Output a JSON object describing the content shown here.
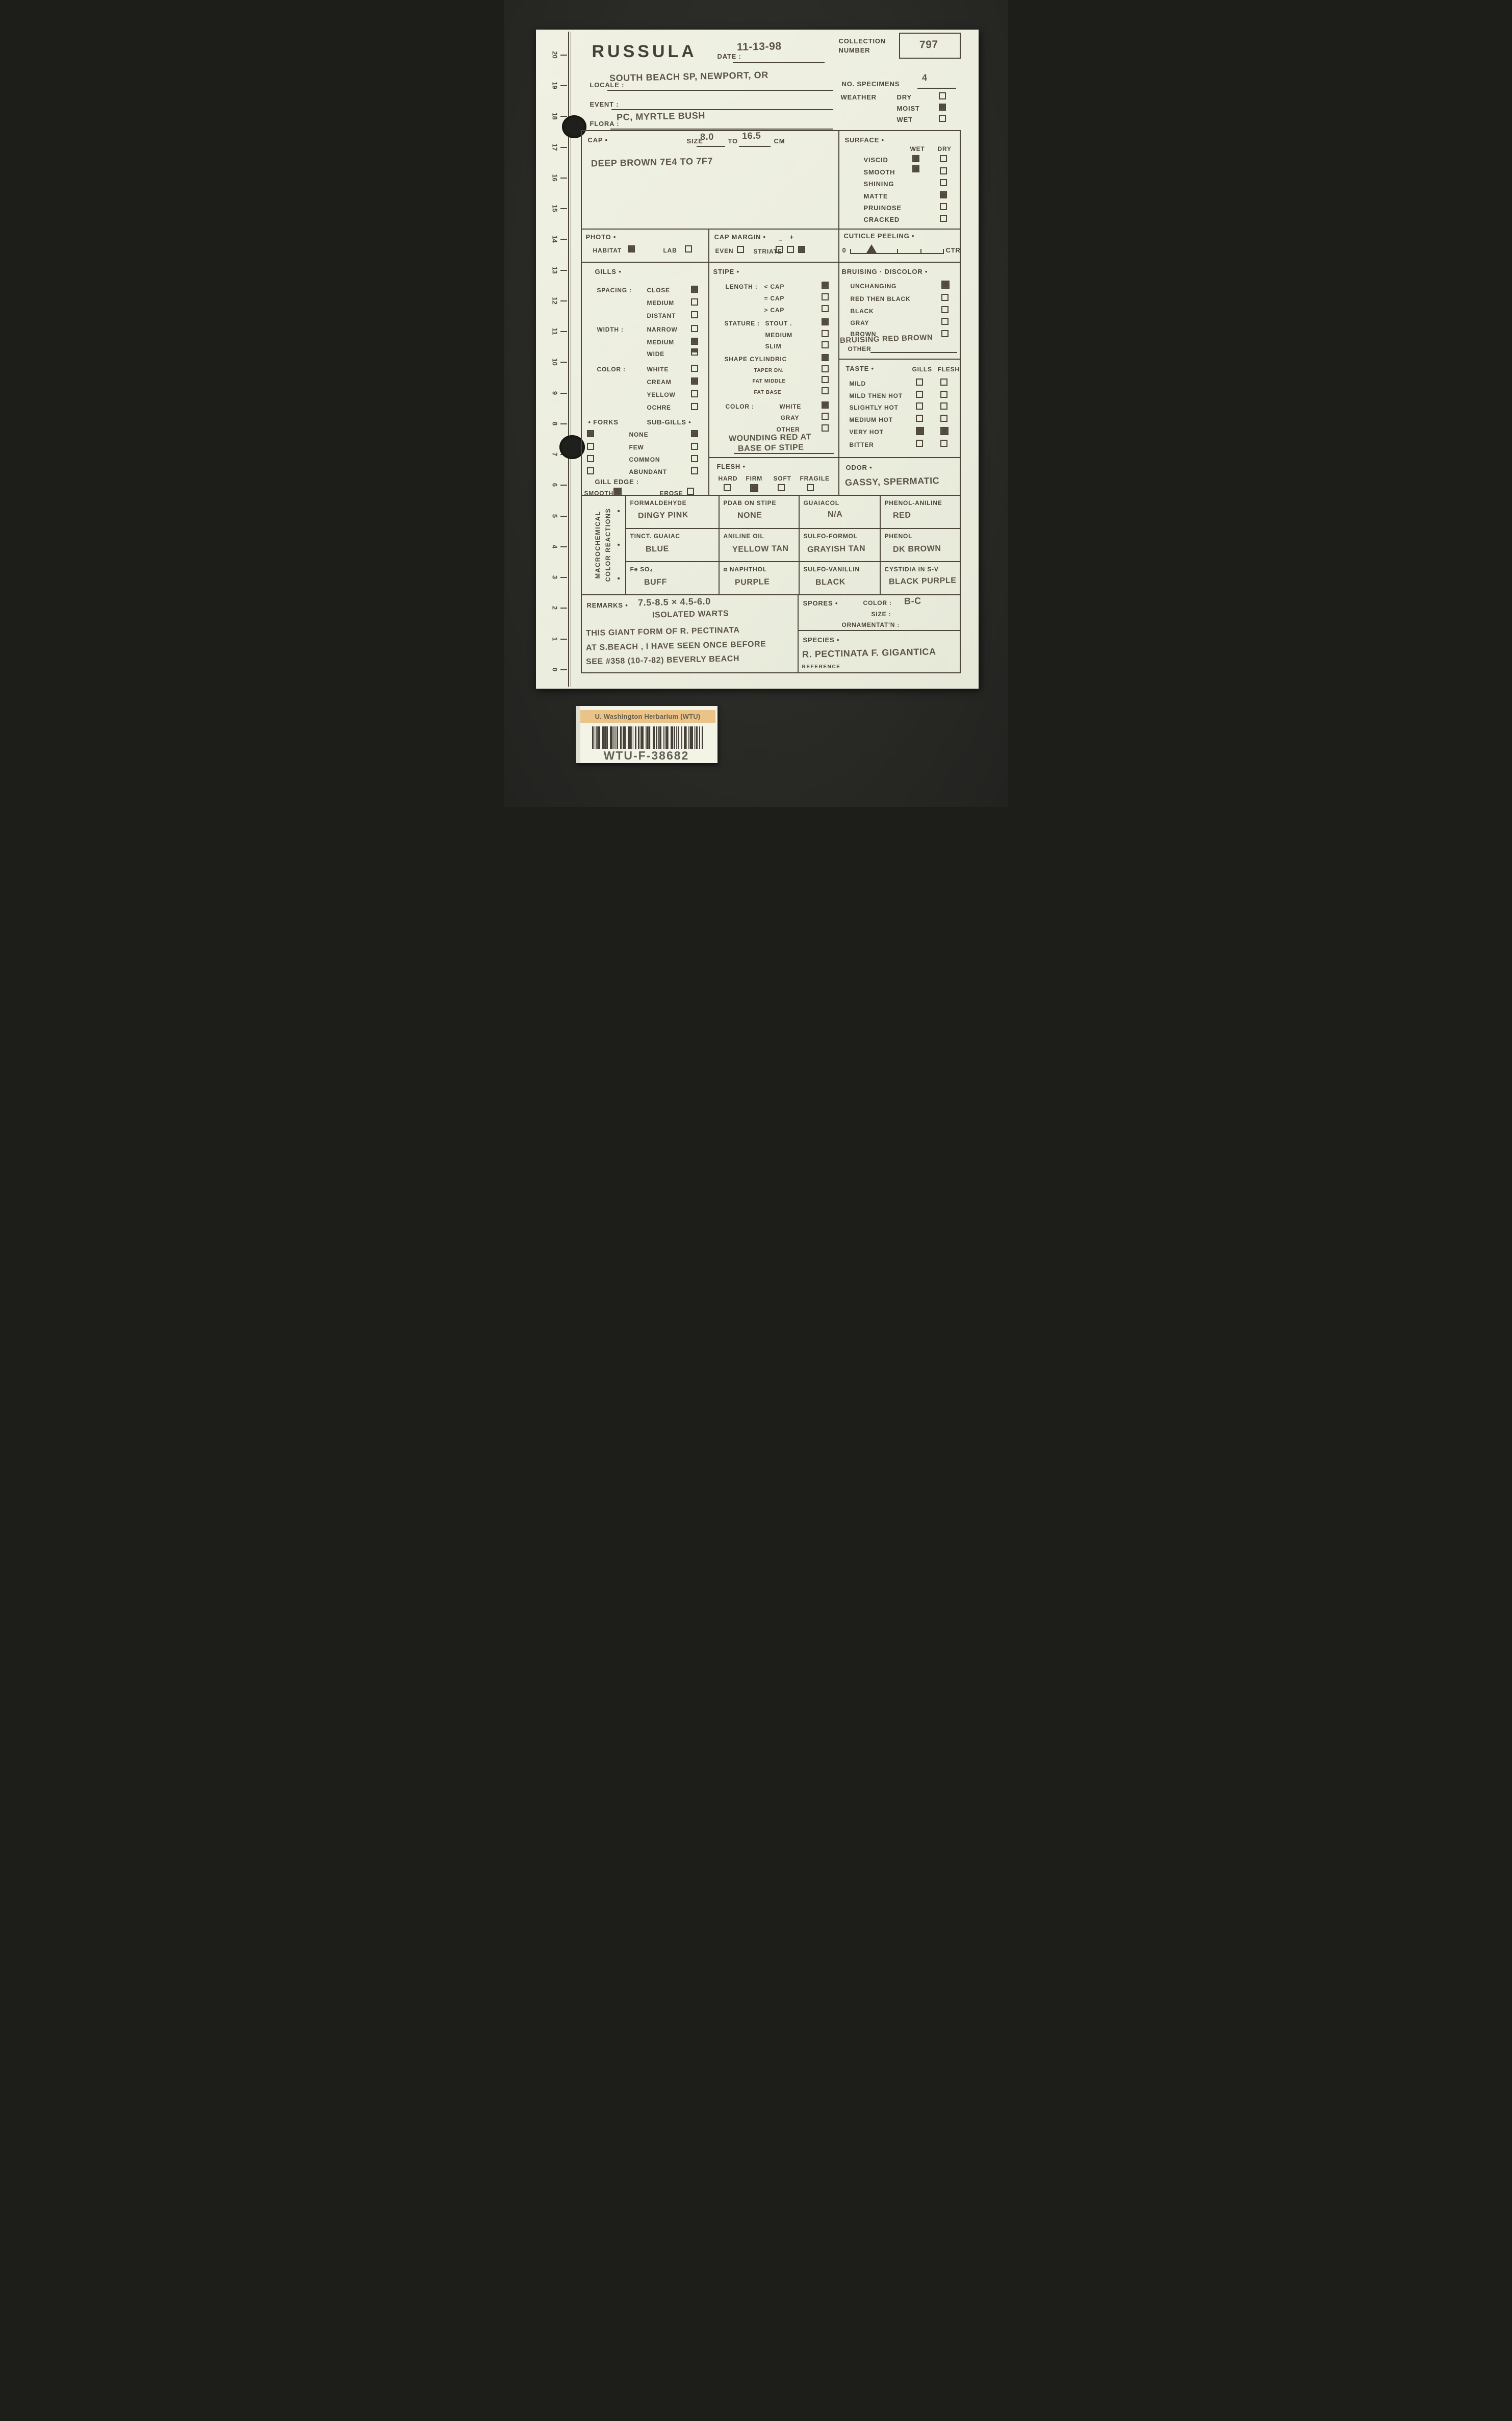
{
  "ruler": {
    "numbers": [
      "20",
      "19",
      "18",
      "17",
      "16",
      "15",
      "14",
      "13",
      "12",
      "11",
      "10",
      "9",
      "8",
      "7",
      "6",
      "5",
      "4",
      "3",
      "2",
      "1",
      "0"
    ]
  },
  "header": {
    "title": "RUSSULA",
    "date_label": "DATE :",
    "date_value": "11-13-98",
    "collection_label_1": "COLLECTION",
    "collection_label_2": "NUMBER",
    "collection_value": "797",
    "locale_label": "LOCALE :",
    "locale_value": "SOUTH BEACH SP, NEWPORT, OR",
    "no_specimens_label": "NO. SPECIMENS",
    "no_specimens_value": "4",
    "weather_label": "WEATHER",
    "weather": [
      {
        "label": "DRY",
        "checked": false
      },
      {
        "label": "MOIST",
        "checked": true
      },
      {
        "label": "WET",
        "checked": false
      }
    ],
    "event_label": "EVENT :",
    "event_value": "",
    "flora_label": "FLORA :",
    "flora_value": "PC, MYRTLE BUSH"
  },
  "cap": {
    "label": "CAP •",
    "size_label": "SIZE",
    "size_min": "8.0",
    "to_label": "TO",
    "size_max": "16.5",
    "unit_label": "CM",
    "color_note": "DEEP BROWN 7E4 TO 7F7"
  },
  "surface": {
    "label": "SURFACE •",
    "wet_header": "WET",
    "dry_header": "DRY",
    "rows": [
      {
        "label": "VISCID",
        "wet": true,
        "dry": false
      },
      {
        "label": "SMOOTH",
        "wet": true,
        "dry": false
      },
      {
        "label": "SHINING",
        "dry": false
      },
      {
        "label": "MATTE",
        "dry": true
      },
      {
        "label": "PRUINOSE",
        "dry": false
      },
      {
        "label": "CRACKED",
        "dry": false
      }
    ]
  },
  "photo": {
    "label": "PHOTO •",
    "habitat_label": "HABITAT",
    "habitat_checked": true,
    "lab_label": "LAB",
    "lab_checked": false
  },
  "cap_margin": {
    "label": "CAP MARGIN •",
    "even_label": "EVEN",
    "even_checked": false,
    "striate_label": "STRIATE",
    "minus": "−",
    "plus": "+",
    "boxes": [
      false,
      false,
      true
    ]
  },
  "cuticle": {
    "label": "CUTICLE PEELING •",
    "zero_label": "0",
    "ctr_label": "CTR"
  },
  "gills": {
    "label": "GILLS •",
    "spacing_label": "SPACING :",
    "spacing": [
      {
        "label": "CLOSE",
        "checked": true
      },
      {
        "label": "MEDIUM",
        "checked": false
      },
      {
        "label": "DISTANT",
        "checked": false
      }
    ],
    "width_label": "WIDTH :",
    "width": [
      {
        "label": "NARROW",
        "checked": false
      },
      {
        "label": "MEDIUM",
        "checked": true
      },
      {
        "label": "WIDE",
        "checked": "half"
      }
    ],
    "color_label": "COLOR :",
    "color": [
      {
        "label": "WHITE",
        "checked": false
      },
      {
        "label": "CREAM",
        "checked": true
      },
      {
        "label": "YELLOW",
        "checked": false
      },
      {
        "label": "OCHRE",
        "checked": false
      }
    ],
    "forks_label": "• FORKS",
    "subgills_label": "SUB-GILLS •",
    "amount_rows": [
      {
        "label": "NONE",
        "forks": true,
        "sub": true
      },
      {
        "label": "FEW",
        "forks": false,
        "sub": false
      },
      {
        "label": "COMMON",
        "forks": false,
        "sub": false
      },
      {
        "label": "ABUNDANT",
        "forks": false,
        "sub": false
      }
    ],
    "edge_label": "GILL EDGE :",
    "smooth_label": "SMOOTH",
    "smooth_checked": true,
    "erose_label": "EROSE",
    "erose_checked": false
  },
  "stipe": {
    "label": "STIPE •",
    "length_label": "LENGTH :",
    "length": [
      {
        "label": "< CAP",
        "checked": true
      },
      {
        "label": "= CAP",
        "checked": false
      },
      {
        "label": "> CAP",
        "checked": false
      }
    ],
    "stature_label": "STATURE :",
    "stature": [
      {
        "label": "STOUT .",
        "checked": true
      },
      {
        "label": "MEDIUM",
        "checked": false
      },
      {
        "label": "SLIM",
        "checked": false
      }
    ],
    "shape_label": "SHAPE :",
    "shape": [
      {
        "label": "CYLINDRIC",
        "checked": true
      },
      {
        "label": "TAPER DN.",
        "checked": false
      },
      {
        "label": "FAT MIDDLE",
        "checked": false
      },
      {
        "label": "FAT BASE",
        "checked": false
      }
    ],
    "color_label": "COLOR :",
    "color": [
      {
        "label": "WHITE",
        "checked": true
      },
      {
        "label": "GRAY",
        "checked": false
      },
      {
        "label": "OTHER",
        "checked": false
      }
    ],
    "note_1": "WOUNDING RED AT",
    "note_2": "BASE OF STIPE"
  },
  "bruising": {
    "label": "BRUISING · DISCOLOR •",
    "options": [
      {
        "label": "UNCHANGING",
        "checked": true
      },
      {
        "label": "RED THEN BLACK",
        "checked": false
      },
      {
        "label": "BLACK",
        "checked": false
      },
      {
        "label": "GRAY",
        "checked": false
      },
      {
        "label": "BROWN",
        "checked": false
      }
    ],
    "other_label": "OTHER",
    "other_value": "BRUISING RED BROWN"
  },
  "taste": {
    "label": "TASTE •",
    "gills_header": "GILLS",
    "flesh_header": "FLESH",
    "rows": [
      {
        "label": "MILD",
        "gills": false,
        "flesh": false
      },
      {
        "label": "MILD THEN HOT",
        "gills": false,
        "flesh": false
      },
      {
        "label": "SLIGHTLY HOT",
        "gills": false,
        "flesh": false
      },
      {
        "label": "MEDIUM HOT",
        "gills": false,
        "flesh": false
      },
      {
        "label": "VERY HOT",
        "gills": true,
        "flesh": true
      },
      {
        "label": "BITTER",
        "gills": false,
        "flesh": false
      }
    ]
  },
  "flesh": {
    "label": "FLESH •",
    "options": [
      {
        "label": "HARD",
        "checked": false
      },
      {
        "label": "FIRM",
        "checked": true
      },
      {
        "label": "SOFT",
        "checked": false
      },
      {
        "label": "FRAGILE",
        "checked": false
      }
    ]
  },
  "odor": {
    "label": "ODOR •",
    "value": "GASSY, SPERMATIC"
  },
  "reactions": {
    "side_label_1": "MACROCHEMICAL",
    "side_label_2": "COLOR REACTIONS",
    "rows": [
      [
        {
          "test": "FORMALDEHYDE",
          "result": "DINGY PINK"
        },
        {
          "test": "PDAB ON STIPE",
          "result": "NONE"
        },
        {
          "test": "GUAIACOL",
          "result": "N/A"
        },
        {
          "test": "PHENOL-ANILINE",
          "result": "RED"
        }
      ],
      [
        {
          "test": "TINCT. GUAIAC",
          "result": "BLUE"
        },
        {
          "test": "ANILINE OIL",
          "result": "YELLOW TAN"
        },
        {
          "test": "SULFO-FORMOL",
          "result": "GRAYISH TAN"
        },
        {
          "test": "PHENOL",
          "result": "DK BROWN"
        }
      ],
      [
        {
          "test": "Fe SO₄",
          "result": "BUFF"
        },
        {
          "test": "α NAPHTHOL",
          "result": "PURPLE"
        },
        {
          "test": "SULFO-VANILLIN",
          "result": "BLACK"
        },
        {
          "test": "CYSTIDIA IN S-V",
          "result": "BLACK PURPLE"
        }
      ]
    ]
  },
  "remarks": {
    "label": "REMARKS •",
    "measure_1": "7.5-8.5 × 4.5-6.0",
    "measure_2": "ISOLATED WARTS",
    "note_1": "THIS GIANT FORM OF R. PECTINATA",
    "note_2": "AT S.BEACH , I HAVE SEEN ONCE BEFORE",
    "note_3": "SEE #358 (10-7-82) BEVERLY BEACH"
  },
  "spores": {
    "label": "SPORES •",
    "color_label": "COLOR :",
    "color_value": "B-C",
    "size_label": "SIZE :",
    "orn_label": "ORNAMENTAT'N :"
  },
  "species": {
    "label": "SPECIES •",
    "value": "R. PECTINATA F. GIGANTICA",
    "reference_label": "REFERENCE"
  },
  "barcode": {
    "org": "U. Washington Herbarium (WTU)",
    "code": "WTU-F-38682"
  },
  "colors": {
    "paper": "#edeee0",
    "ink": "#4c4539",
    "handwriting": "#5d5546",
    "mat": "#2c2c28",
    "band": "#eac389"
  }
}
